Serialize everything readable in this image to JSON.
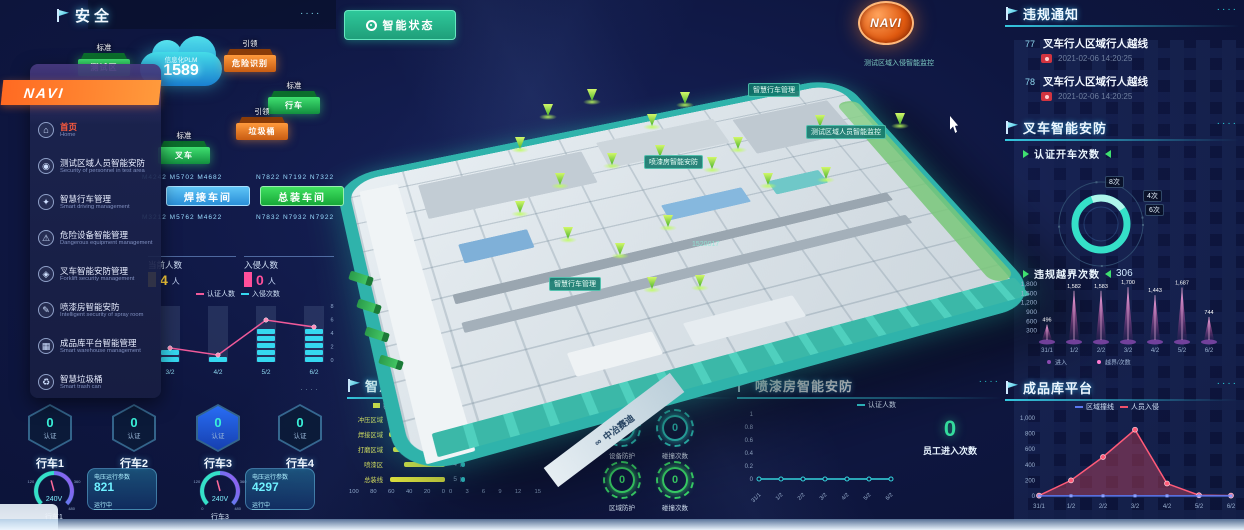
{
  "topbar": {
    "title": "安全",
    "dots": "····"
  },
  "status_button": {
    "label": "智能状态"
  },
  "navi_badge": {
    "label": "NAVI"
  },
  "menu": {
    "brand": "NAVI",
    "items": [
      {
        "label": "首页",
        "sub": "Home",
        "icon": "home-icon",
        "active": true
      },
      {
        "label": "测试区域人员智能安防",
        "sub": "Security of personnel in test area",
        "icon": "people-icon",
        "active": false
      },
      {
        "label": "智慧行车管理",
        "sub": "Smart driving management",
        "icon": "crane-icon",
        "active": false
      },
      {
        "label": "危险设备智能管理",
        "sub": "Dangerous equipment management",
        "icon": "warning-icon",
        "active": false
      },
      {
        "label": "叉车智能安防管理",
        "sub": "Forklift security management",
        "icon": "forklift-icon",
        "active": false
      },
      {
        "label": "喷漆房智能安防",
        "sub": "Intelligent security of spray room",
        "icon": "paint-icon",
        "active": false
      },
      {
        "label": "成品库平台智能管理",
        "sub": "Smart warehouse management",
        "icon": "warehouse-icon",
        "active": false
      },
      {
        "label": "智慧垃圾桶",
        "sub": "Smart trash can",
        "icon": "trash-icon",
        "active": false
      }
    ]
  },
  "overview": {
    "cloud": {
      "label": "信息化PLM",
      "value": "1589"
    },
    "badges": [
      {
        "tier": "标准",
        "name": "测试区",
        "color": "green"
      },
      {
        "tier": "引领",
        "name": "危险识别",
        "color": "orange"
      },
      {
        "tier": "标准",
        "name": "行车",
        "color": "green"
      },
      {
        "tier": "引领",
        "name": "垃圾桶",
        "color": "orange"
      },
      {
        "tier": "标准",
        "name": "叉车",
        "color": "green"
      }
    ],
    "workshops": [
      {
        "name": "焊接车间",
        "color": "blue",
        "codes_top": "M4242  M5702  M4682",
        "codes_bottom": "M3212  M5762  M4622"
      },
      {
        "name": "总装车间",
        "color": "green",
        "codes_top": "N7822  N7192  N7322",
        "codes_bottom": "N7832  N7932  N7922"
      }
    ],
    "people": {
      "current_label": "当前人数",
      "current_value": "4",
      "current_unit": "人",
      "intrusion_label": "入侵人数",
      "intrusion_value": "0",
      "intrusion_unit": "人"
    },
    "chart": {
      "type": "bar+line",
      "legend": [
        "认证人数",
        "入侵次数"
      ],
      "dots": "····",
      "x": [
        "3/2",
        "4/2",
        "5/2",
        "6/2"
      ],
      "bars": [
        2,
        1,
        5,
        5
      ],
      "line": [
        2,
        1,
        6,
        5
      ],
      "right_axis": [
        "8",
        "6",
        "4",
        "2",
        "0"
      ]
    }
  },
  "map": {
    "ribbon_text": "中冶赛迪",
    "tags": [
      {
        "text": "智慧行车管理",
        "x": 748,
        "y": 83,
        "plain": false
      },
      {
        "text": "测试区域人员智能监控",
        "x": 806,
        "y": 125,
        "plain": false
      },
      {
        "text": "喷漆房智能安防",
        "x": 644,
        "y": 155,
        "plain": false
      },
      {
        "text": "智慧行车管理",
        "x": 549,
        "y": 277,
        "plain": false
      },
      {
        "text": "测试区域入侵智能监控",
        "x": 860,
        "y": 57,
        "plain": true
      },
      {
        "text": "1520017",
        "x": 688,
        "y": 240,
        "plain": true
      }
    ],
    "pins": [
      [
        520,
        150
      ],
      [
        548,
        117
      ],
      [
        592,
        102
      ],
      [
        652,
        127
      ],
      [
        685,
        105
      ],
      [
        738,
        150
      ],
      [
        820,
        128
      ],
      [
        900,
        126
      ],
      [
        560,
        186
      ],
      [
        612,
        166
      ],
      [
        660,
        158
      ],
      [
        712,
        170
      ],
      [
        768,
        186
      ],
      [
        826,
        180
      ],
      [
        520,
        214
      ],
      [
        568,
        240
      ],
      [
        620,
        256
      ],
      [
        668,
        228
      ],
      [
        652,
        290
      ],
      [
        700,
        288
      ]
    ],
    "trucks": [
      [
        349,
        274
      ],
      [
        357,
        302
      ],
      [
        365,
        330
      ],
      [
        379,
        358
      ]
    ]
  },
  "panels": {
    "violations": {
      "title": "违规通知",
      "dots": "····",
      "items": [
        {
          "id": "77",
          "text": "叉车行人区域行人越线",
          "time": "2021-02-06 14:20:25"
        },
        {
          "id": "78",
          "text": "叉车行人区域行人越线",
          "time": "2021-02-06 14:20:25"
        }
      ]
    },
    "forklift": {
      "title": "叉车智能安防",
      "dots": "····",
      "donut_label": "认证开车次数",
      "callouts": [
        "8次",
        "4次",
        "6次"
      ],
      "crossing_label": "违规越界次数",
      "crossing_value": "306",
      "crossing_chart": {
        "type": "spike",
        "x": [
          "31/1",
          "1/2",
          "2/2",
          "3/2",
          "4/2",
          "5/2",
          "6/2"
        ],
        "values": [
          496,
          1582,
          1583,
          1700,
          1443,
          1687,
          744
        ],
        "ylim": [
          0,
          1800
        ],
        "yticks": [
          1800,
          1500,
          1200,
          900,
          600,
          300
        ],
        "legend": [
          "进入",
          "越界/次数"
        ]
      }
    },
    "finished": {
      "title": "成品库平台",
      "dots": "····",
      "chart": {
        "type": "area",
        "legend": [
          {
            "label": "区域撞线",
            "color": "#5a78f0"
          },
          {
            "label": "人员入侵",
            "color": "#f0506a"
          }
        ],
        "x": [
          "31/1",
          "1/2",
          "2/2",
          "3/2",
          "4/2",
          "5/2",
          "6/2"
        ],
        "red": [
          5,
          200,
          500,
          850,
          160,
          10,
          5
        ],
        "blue": [
          2,
          2,
          2,
          2,
          2,
          2,
          2
        ],
        "yticks": [
          1000,
          800,
          600,
          400,
          200,
          0
        ],
        "ylim": [
          0,
          1000
        ]
      }
    },
    "trash": {
      "title": "智慧垃圾桶",
      "dots": "····",
      "legend": [
        {
          "label": "容量",
          "color": "#e8e83c"
        },
        {
          "label": "余量",
          "color": "#35d8e0"
        }
      ],
      "left_chart": {
        "type": "bar",
        "categories": [
          "冲压区域",
          "焊接区域",
          "打磨区域",
          "喷漆区",
          "总装线"
        ],
        "values": [
          90,
          95,
          88,
          70,
          93
        ],
        "axis": [
          "100",
          "80",
          "60",
          "40",
          "20",
          "0"
        ],
        "max": 100
      },
      "right_chart": {
        "type": "bar",
        "categories": [
          "1",
          "2",
          "3",
          "4",
          "5"
        ],
        "values": [
          9,
          7.5,
          4.5,
          0.8,
          0.8
        ],
        "axis": [
          "0",
          "3",
          "6",
          "9",
          "12",
          "15"
        ],
        "max": 15
      }
    },
    "crane_equip": {
      "title": "行车设备",
      "dots": "····",
      "rings": [
        {
          "value": "0",
          "label": "设备防护",
          "color": "cyan"
        },
        {
          "value": "0",
          "label": "碰撞次数",
          "color": "cyan"
        },
        {
          "value": "0",
          "label": "区域防护",
          "color": "green"
        },
        {
          "value": "0",
          "label": "碰撞次数",
          "color": "green"
        }
      ]
    },
    "paint": {
      "title": "喷漆房智能安防",
      "dots": "····",
      "legend": "认证人数",
      "chart": {
        "type": "line",
        "yticks": [
          "1",
          "0.8",
          "0.6",
          "0.4",
          "0.2",
          "0"
        ],
        "x": [
          "31/1",
          "1/2",
          "2/2",
          "3/2",
          "4/2",
          "5/2",
          "6/2"
        ],
        "values": [
          0,
          0,
          0,
          0,
          0,
          0,
          0
        ]
      },
      "stat_value": "0",
      "stat_label": "员工进入次数"
    },
    "cranes": {
      "hexes": [
        {
          "name": "行车1",
          "value": "0",
          "label": "认证",
          "highlight": false
        },
        {
          "name": "行车2",
          "value": "0",
          "label": "认证",
          "highlight": false
        },
        {
          "name": "行车3",
          "value": "0",
          "label": "认证",
          "highlight": true
        },
        {
          "name": "行车4",
          "value": "0",
          "label": "认证",
          "highlight": false
        }
      ],
      "gauges": [
        {
          "value": "240V",
          "label": "行车1",
          "ticks": [
            "0",
            "120",
            "240",
            "360",
            "480"
          ]
        },
        {
          "value": "240V",
          "label": "行车3",
          "ticks": [
            "0",
            "120",
            "240",
            "360",
            "480"
          ]
        }
      ],
      "cards": [
        {
          "title": "电压运行参数",
          "value": "821",
          "sub": "运行中"
        },
        {
          "title": "电压运行参数",
          "value": "4297",
          "sub": "运行中"
        }
      ]
    }
  }
}
